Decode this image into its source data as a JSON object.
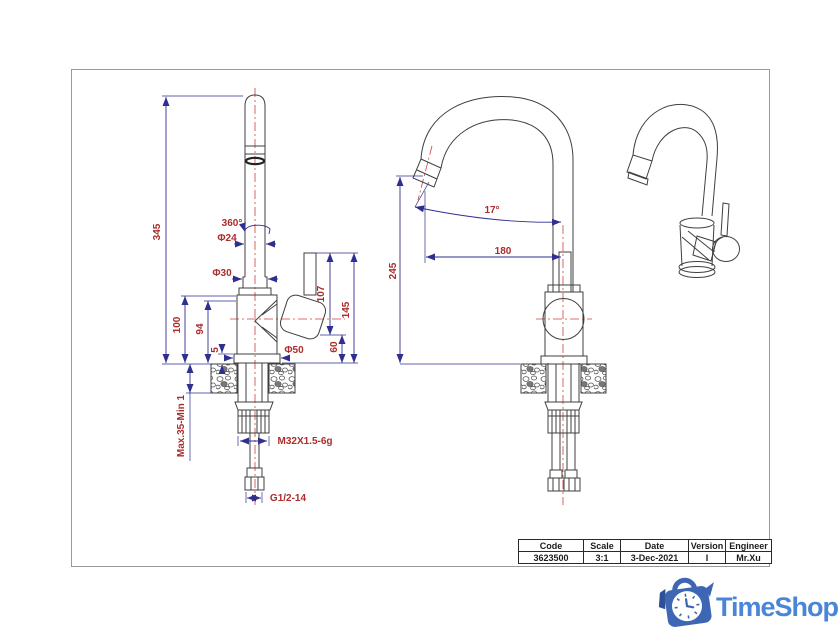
{
  "drawing": {
    "title_block": {
      "columns": [
        {
          "header": "Code",
          "value": "3623500"
        },
        {
          "header": "Scale",
          "value": "3:1"
        },
        {
          "header": "Date",
          "value": "3-Dec-2021"
        },
        {
          "header": "Version",
          "value": "I"
        },
        {
          "header": "Engineer",
          "value": "Mr.Xu"
        }
      ]
    },
    "annotations": [
      {
        "text": "345",
        "x": 160,
        "y": 232,
        "rot": -90
      },
      {
        "text": "360°",
        "x": 232,
        "y": 226,
        "rot": 0
      },
      {
        "text": "Φ24",
        "x": 227,
        "y": 241,
        "rot": 0
      },
      {
        "text": "Φ30",
        "x": 222,
        "y": 276,
        "rot": 0
      },
      {
        "text": "100",
        "x": 180,
        "y": 325,
        "rot": -90
      },
      {
        "text": "94",
        "x": 203,
        "y": 329,
        "rot": -90
      },
      {
        "text": "5",
        "x": 218,
        "y": 350,
        "rot": -90
      },
      {
        "text": "Φ50",
        "x": 294,
        "y": 353,
        "rot": 0
      },
      {
        "text": "107",
        "x": 324,
        "y": 294,
        "rot": -90
      },
      {
        "text": "60",
        "x": 337,
        "y": 347,
        "rot": -90
      },
      {
        "text": "145",
        "x": 349,
        "y": 310,
        "rot": -90
      },
      {
        "text": "Max.35-Min 1",
        "x": 184,
        "y": 426,
        "rot": -90
      },
      {
        "text": "M32X1.5-6g",
        "x": 305,
        "y": 444,
        "rot": 0
      },
      {
        "text": "G1/2-14",
        "x": 288,
        "y": 501,
        "rot": 0
      },
      {
        "text": "17°",
        "x": 492,
        "y": 213,
        "rot": 0
      },
      {
        "text": "180",
        "x": 503,
        "y": 254,
        "rot": 0
      },
      {
        "text": "245",
        "x": 396,
        "y": 271,
        "rot": -90
      }
    ],
    "colors": {
      "dimension_lines": "#2f2f8f",
      "dimension_text": "#ac2c2c",
      "centerline": "#cc4040",
      "object_lines": "#3f3f3f"
    }
  },
  "logo": {
    "text": "TimeShop",
    "colors": {
      "text": "#4a85d6",
      "bag": "#3d66b5",
      "bag_dark": "#2f4f96"
    }
  }
}
